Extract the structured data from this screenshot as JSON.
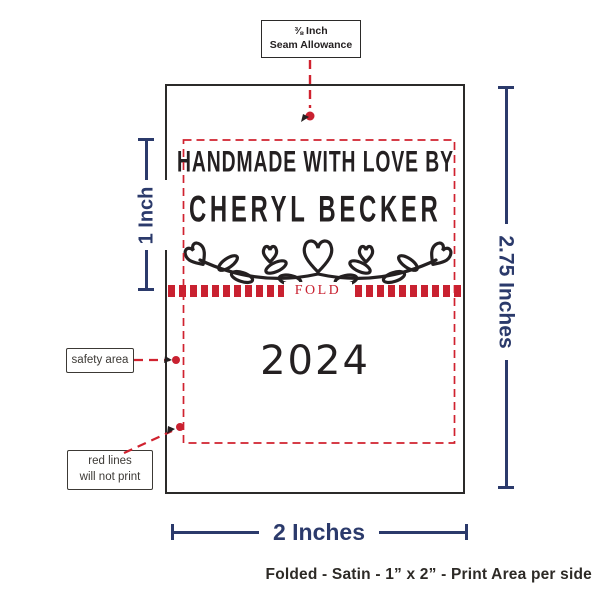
{
  "seam_note": {
    "line1": "⅜ Inch",
    "line2": "Seam Allowance"
  },
  "label": {
    "title_prefix": "HANDMADE WITH LOVE BY",
    "maker_name": "CHERYL BECKER",
    "fold_text": "FOLD",
    "year": "2024"
  },
  "dimensions": {
    "print_height": "1 Inch",
    "total_height": "2.75 Inches",
    "width": "2 Inches"
  },
  "notes": {
    "safety_area": "safety area",
    "red_lines_line1": "red lines",
    "red_lines_line2": "will not print"
  },
  "caption": "Folded - Satin - 1” x 2” - Print Area per side",
  "colors": {
    "navy": "#2b3a6b",
    "red": "#c92130",
    "ink": "#242021"
  }
}
